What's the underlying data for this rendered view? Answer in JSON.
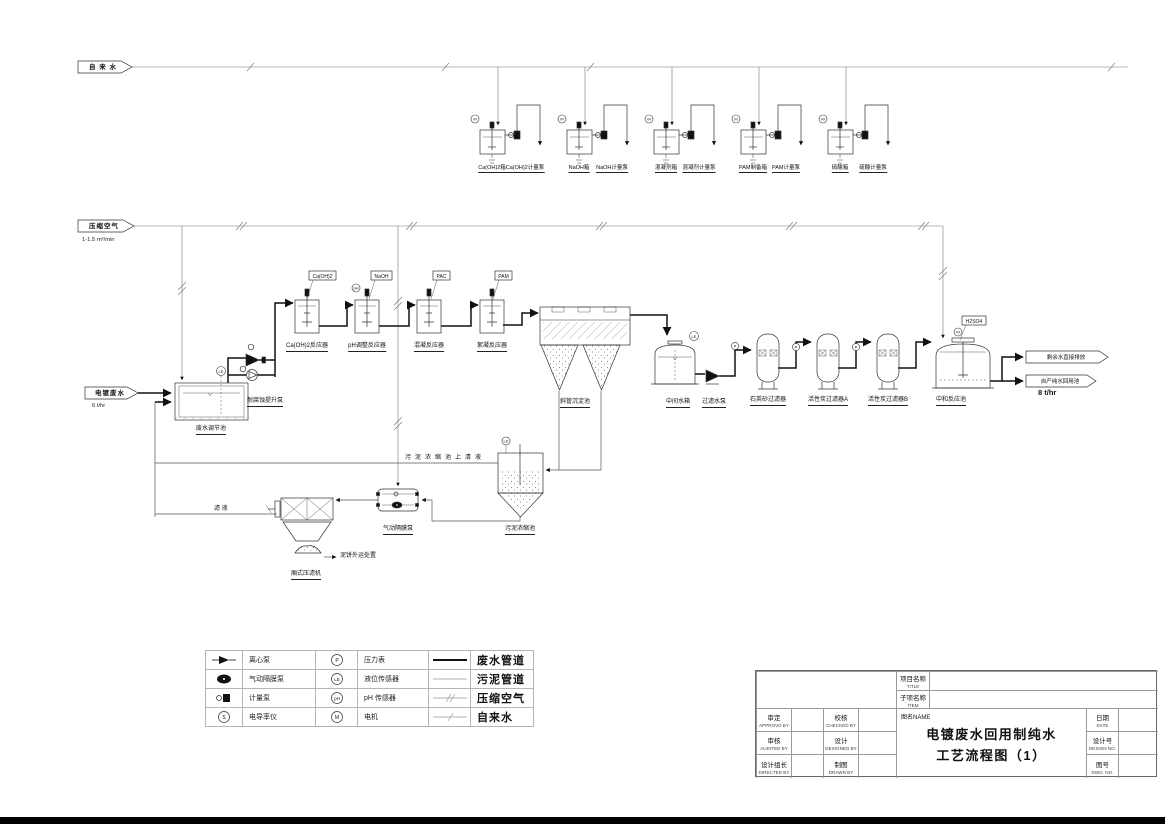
{
  "drawing": {
    "headers": {
      "tap_water": "自 来 水",
      "compressed_air": "压缩空气",
      "air_flow": "1-1.5 m³/min"
    },
    "inflow": {
      "label": "电镀废水",
      "flow": "6 t/hr"
    },
    "outflows": {
      "discharge": "剩余水直接排放",
      "reuse": "自产纯水回用池",
      "reuse_flow": "8 t/hr"
    },
    "dosing_units": [
      {
        "tank": "Ca(OH)2箱",
        "pump": "Ca(OH)2计量泵"
      },
      {
        "tank": "NaOH箱",
        "pump": "NaOH计量泵"
      },
      {
        "tank": "混凝剂箱",
        "pump": "混凝剂计量泵"
      },
      {
        "tank": "PAM制备箱",
        "pump": "PAM计量泵"
      },
      {
        "tank": "硫酸箱",
        "pump": "硫酸计量泵"
      }
    ],
    "reactors": [
      {
        "tag": "Ca(OH)2",
        "label": "Ca(OH)2反应器"
      },
      {
        "tag": "NaOH",
        "label": "pH调整反应器"
      },
      {
        "tag": "PAC",
        "label": "混凝反应器"
      },
      {
        "tag": "PAM",
        "label": "絮凝反应器"
      }
    ],
    "equipment": {
      "regulating_tank": "废水调节池",
      "lift_pump": "耐腐蚀提升泵",
      "settler": "斜管沉淀池",
      "intermediate_tank": "中间水箱",
      "filter_pump": "过滤水泵",
      "sand_filter": "石英砂过滤器",
      "carbon_filter_a": "活性炭过滤器A",
      "carbon_filter_b": "活性炭过滤器B",
      "neutralization_tank": "中和反应池",
      "acid_tag": "H2SO4",
      "sludge_thickener": "污泥浓缩池",
      "diaphragm_pump": "气动隔膜泵",
      "filter_press": "厢式压滤机",
      "cake_disposal": "泥饼外运处置",
      "filtrate": "滤 液",
      "supernatant": "污泥浓缩池上清液"
    },
    "instruments": {
      "pressure": "P",
      "level": "LE",
      "ph": "pH",
      "motor": "M",
      "conductivity": "S"
    }
  },
  "legend": {
    "rows": [
      {
        "label1": "离心泵",
        "label2": "压力表",
        "label3": "废水管道"
      },
      {
        "label1": "气动隔膜泵",
        "label2": "液位传感器",
        "label3": "污泥管道"
      },
      {
        "label1": "计量泵",
        "label2": "pH 传感器",
        "label3": "压缩空气"
      },
      {
        "label1": "电导率仪",
        "label2": "电机",
        "label3": "自来水"
      }
    ]
  },
  "titleblock": {
    "project_cn": "项目名称",
    "project_en": "TITLE",
    "item_cn": "子项名称",
    "item_en": "ITEM",
    "name_label": "图名NAME",
    "title_line1": "电镀废水回用制纯水",
    "title_line2": "工艺流程图（1）",
    "sign_cells": [
      {
        "cn": "审定",
        "en": "APPROVD BY"
      },
      {
        "cn": "校核",
        "en": "CHECKED BY"
      },
      {
        "cn": "审核",
        "en": "AUDITED BY"
      },
      {
        "cn": "设计",
        "en": "DESIGNED BY"
      },
      {
        "cn": "设计组长",
        "en": "DIRECTED BY"
      },
      {
        "cn": "制图",
        "en": "DRAWN BY"
      }
    ],
    "right_cells": [
      {
        "cn": "日期",
        "en": "DATE"
      },
      {
        "cn": "设计号",
        "en": "DESIGN NO."
      },
      {
        "cn": "图号",
        "en": "DWG. NO."
      }
    ]
  }
}
